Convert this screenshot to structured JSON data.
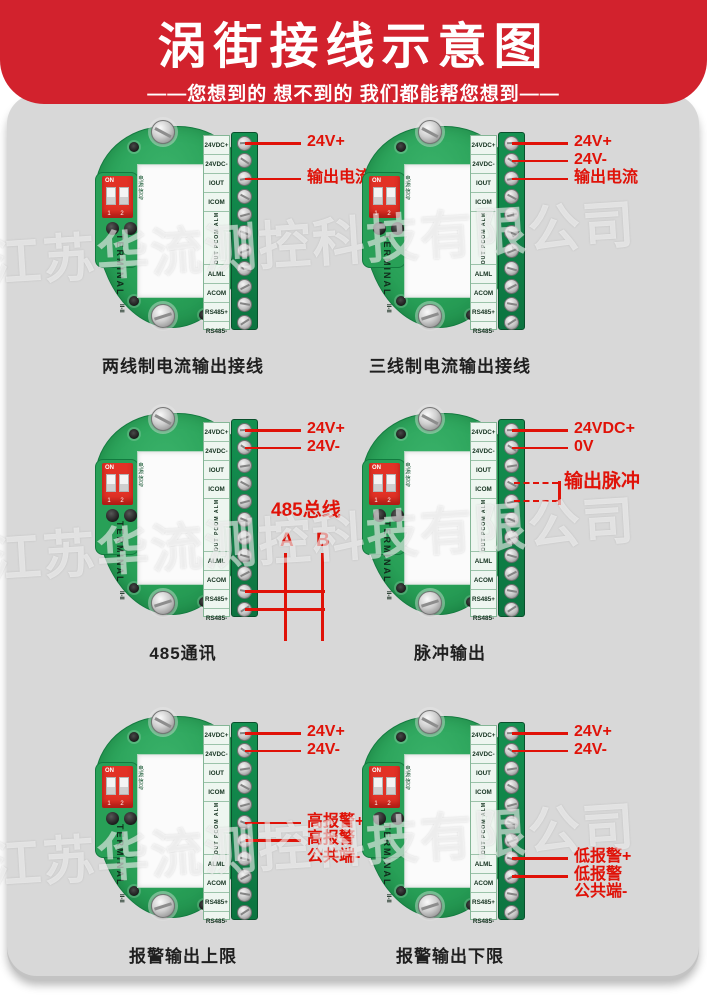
{
  "page": {
    "bg": "#ffffff",
    "panel_bg": "#d8d8d8"
  },
  "colors": {
    "header_red": "#d2222d",
    "annotation_red": "#e01208",
    "board_green": "#28a057",
    "strip_green": "#0c7440",
    "watermark": "rgba(255,255,255,0.55)"
  },
  "header": {
    "title": "涡街接线示意图",
    "subtitle": "——您想到的 想不到的 我们都能帮您想到——"
  },
  "watermark": {
    "text": "江苏华流测控科技有限公司"
  },
  "board": {
    "terminal_labels": [
      "24VDC+",
      "24VDC-",
      "IOUT",
      "ICOM",
      "POUT PCOM ALMH",
      "ALML",
      "ACOM",
      "RS485+",
      "RS485-"
    ],
    "vertical_label_index": 4,
    "screw_count": 11,
    "dip_on": "ON",
    "dip_numbers": "1 2",
    "dip_side_text": "电源信号",
    "side_text": "TERMINAL",
    "side_text_sub": "II-II"
  },
  "modules": [
    {
      "id": "two-wire-current",
      "caption": "两线制电流输出接线",
      "annotations": [
        {
          "text": "24V+",
          "screw": 1
        },
        {
          "text": "输出电流",
          "screw": 3
        }
      ]
    },
    {
      "id": "three-wire-current",
      "caption": "三线制电流输出接线",
      "annotations": [
        {
          "text": "24V+",
          "screw": 1
        },
        {
          "text": "24V-",
          "screw": 2
        },
        {
          "text": "输出电流",
          "screw": 3
        }
      ]
    },
    {
      "id": "rs485-comm",
      "caption": "485通讯",
      "annotations": [
        {
          "text": "24V+",
          "screw": 1
        },
        {
          "text": "24V-",
          "screw": 2
        }
      ],
      "bus": {
        "label": "485总线",
        "wire_a": "A",
        "wire_b": "B",
        "screws": [
          10,
          11
        ]
      }
    },
    {
      "id": "pulse-output",
      "caption": "脉冲输出",
      "annotations": [
        {
          "text": "24VDC+",
          "screw": 1
        },
        {
          "text": "0V",
          "screw": 2
        }
      ],
      "pulse": {
        "label": "输出脉冲",
        "screws": [
          4,
          5
        ]
      }
    },
    {
      "id": "alarm-high",
      "caption": "报警输出上限",
      "annotations": [
        {
          "text": "24V+",
          "screw": 1
        },
        {
          "text": "24V-",
          "screw": 2
        },
        {
          "text": "高报警+",
          "screw": 6
        },
        {
          "text": "高报警",
          "text2": "公共端-",
          "screw": 7
        }
      ]
    },
    {
      "id": "alarm-low",
      "caption": "报警输出下限",
      "annotations": [
        {
          "text": "24V+",
          "screw": 1
        },
        {
          "text": "24V-",
          "screw": 2
        },
        {
          "text": "低报警+",
          "screw": 8
        },
        {
          "text": "低报警",
          "text2": "公共端-",
          "screw": 9
        }
      ]
    }
  ]
}
